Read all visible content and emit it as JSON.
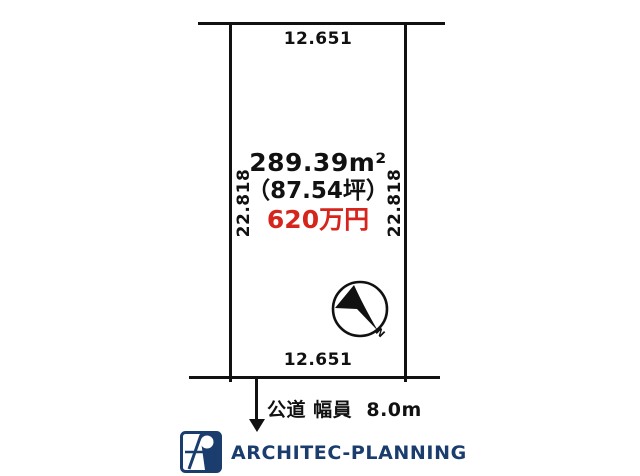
{
  "plot": {
    "top_dimension": "12.651",
    "bottom_dimension": "12.651",
    "left_dimension": "22.818",
    "right_dimension": "22.818",
    "area_sqm": "289.39m²",
    "area_tsubo": "（87.54坪）",
    "price": "620万円",
    "road_label": "公道 幅員  8.0m",
    "compass_north": "N"
  },
  "branding": {
    "company": "ARCHITEC-PLANNING"
  },
  "colors": {
    "line_black": "#111111",
    "price_red": "#d6251c",
    "brand_navy": "#1b3d6d"
  }
}
